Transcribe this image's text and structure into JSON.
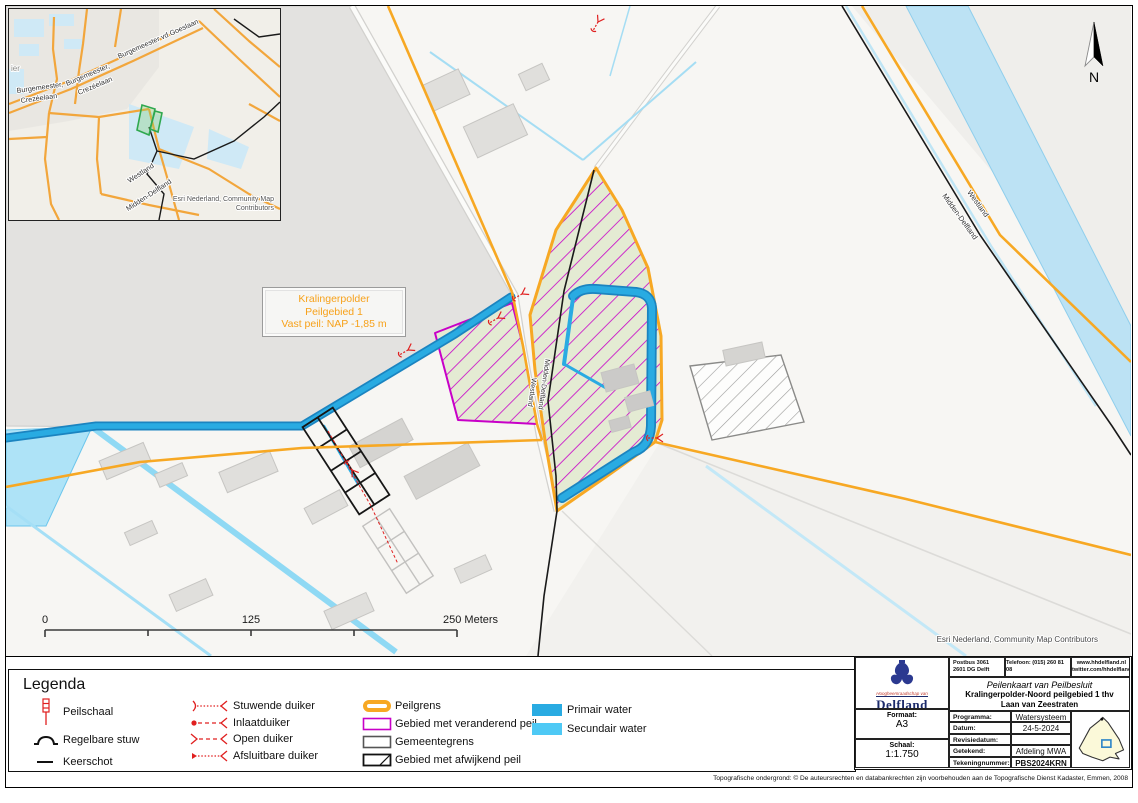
{
  "colors": {
    "peilgrens_orange": "#F7A823",
    "veranderend_magenta": "#C800C8",
    "primair_water": "#29ABE2",
    "secundair_water": "#4EC9F5",
    "duiker_red": "#E02020",
    "peilgebied_fill": "#E4EBD3",
    "polder_gray": "#E3E2E0"
  },
  "inset": {
    "city_partial": "ier",
    "road_left_1": "Burgemeester,",
    "road_left_2": "Crezéelaan",
    "road_diag_1": "Burgemeester,",
    "road_diag_2": "Crezéelaan",
    "road_goeslaan": "Burgemeester vd Goeslaan",
    "westland": "Westland",
    "midden_delfland": "Midden-Delfland",
    "attribution_1": "Esri Nederland, Community Map",
    "attribution_2": "Contributors"
  },
  "map": {
    "area_label_1": "Kralingerpolder",
    "area_label_2": "Peilgebied 1",
    "area_label_3": "Vast peil: NAP -1,85 m",
    "center_labels": {
      "westland": "Westland",
      "midden": "Midden-Delfland"
    },
    "ne_labels": {
      "westland": "Westland",
      "midden": "Midden-Delfland"
    },
    "attribution": "Esri Nederland, Community Map Contributors",
    "north": "N",
    "scale": {
      "zero": "0",
      "mid": "125",
      "end": "250 Meters"
    }
  },
  "legend": {
    "title": "Legenda",
    "items": [
      {
        "label": "Peilschaal"
      },
      {
        "label": "Regelbare stuw"
      },
      {
        "label": "Keerschot"
      },
      {
        "label": "Stuwende duiker"
      },
      {
        "label": "Inlaatduiker"
      },
      {
        "label": "Open duiker"
      },
      {
        "label": "Afsluitbare duiker"
      },
      {
        "label": "Peilgrens"
      },
      {
        "label": "Gebied met veranderend peil"
      },
      {
        "label": "Gemeentegrens"
      },
      {
        "label": "Gebied met afwijkend peil"
      },
      {
        "label": "Primair water"
      },
      {
        "label": "Secundair water"
      }
    ]
  },
  "titleblock": {
    "postbus_1": "Postbus 3061",
    "postbus_2": "2601 DG Delft",
    "telefoon": "Telefoon: (015) 260 81 08",
    "web_1": "www.hhdelfland.nl",
    "web_2": "twitter.com/hhdelfland",
    "doc_type": "Peilenkaart van Peilbesluit",
    "doc_title": "Kralingerpolder-Noord peilgebied 1 thv Laan van Zeestraten",
    "org_script": "Hoogheemraadschap van",
    "org": "Delfland",
    "formaat_label": "Formaat:",
    "formaat": "A3",
    "schaal_label": "Schaal:",
    "schaal": "1:1.750",
    "rows": [
      {
        "label": "Programma:",
        "value": "Watersysteem"
      },
      {
        "label": "Datum:",
        "value": "24-5-2024 14:55"
      },
      {
        "label": "Revisiedatum:",
        "value": ""
      },
      {
        "label": "Getekend:",
        "value": "Afdeling MWA"
      },
      {
        "label": "Tekeningnummer:",
        "value": "PBS2024KRN 1"
      }
    ]
  },
  "footer": {
    "copyright": "Topografische ondergrond: ©  De auteursrechten en databankrechten zijn voorbehouden aan de Topografische Dienst Kadaster, Emmen, 2008"
  }
}
